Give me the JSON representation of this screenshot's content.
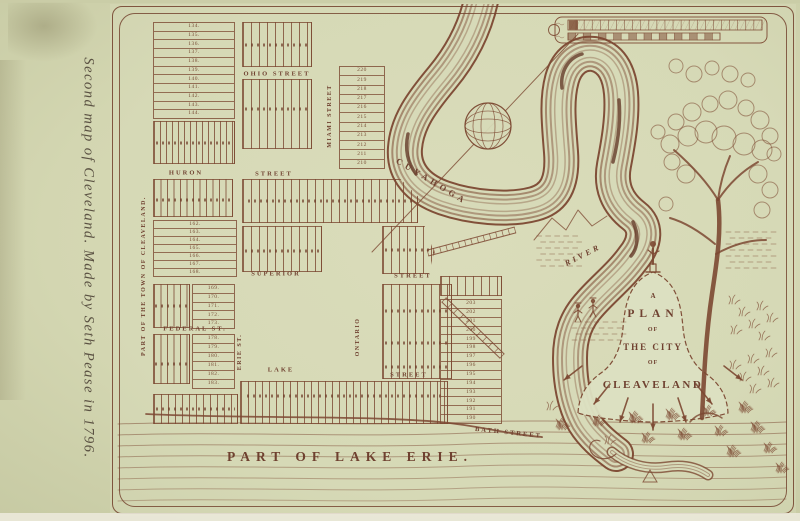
{
  "slide": {
    "caption": "Second map of Cleveland. Made by Seth Pease in 1796."
  },
  "map": {
    "side_label": "Part of the Town of Cleaveland.",
    "streets": {
      "ohio": "Ohio Street",
      "huron": "Huron",
      "huron2": "Street",
      "superior": "Superior",
      "superior2": "Street",
      "federal": "Federal St.",
      "lake": "Lake",
      "lake2": "Street",
      "bath": "Bath Street.",
      "miami": "Miami Street",
      "ontario": "Ontario",
      "erie": "Erie St."
    },
    "water": {
      "river1": "Cuyahoga",
      "river2": "River",
      "lake_erie": "Part of Lake Erie."
    },
    "cartouche": {
      "l1": "A",
      "l2": "Plan",
      "l3": "of",
      "l4": "the City",
      "l5": "of",
      "l6": "Cleaveland"
    },
    "lots": {
      "block_a": [
        "134.",
        "135.",
        "136.",
        "137.",
        "138.",
        "139.",
        "140.",
        "141.",
        "142.",
        "143.",
        "144."
      ],
      "block_c": [
        "220",
        "219",
        "218",
        "217",
        "216",
        "215",
        "214",
        "213",
        "212",
        "211",
        "210"
      ],
      "block_d": [
        "162.",
        "163.",
        "164.",
        "165.",
        "166.",
        "167.",
        "168."
      ],
      "block_f_upper": [
        "169.",
        "170.",
        "171.",
        "172.",
        "173."
      ],
      "block_f_lower": [
        "178.",
        "179.",
        "180.",
        "181.",
        "182.",
        "183."
      ],
      "block_river": [
        "203",
        "202",
        "201",
        "200",
        "199",
        "198",
        "197",
        "196",
        "195",
        "194",
        "193",
        "192",
        "191",
        "190"
      ]
    }
  }
}
